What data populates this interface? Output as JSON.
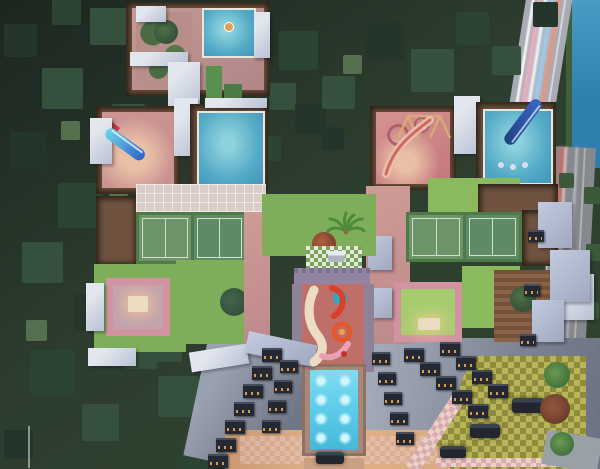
{
  "scene": {
    "type": "3d-aerial-architectural-render",
    "subject": "night-time top-down view of a residential tower complex with rooftop amenity terraces, surrounded by dense trees, a canal and roads with car light trails",
    "features": [
      "rooftop-swimming-pool-left-tower",
      "rooftop-swimming-pool-right-tower",
      "kids-pool-top-terrace",
      "water-slide-blue",
      "pool-slide-navy",
      "tennis-courts-left",
      "tennis-courts-right",
      "seating-courtyard-left",
      "seating-courtyard-right",
      "kids-play-mural",
      "lap-pool-with-underwater-lights",
      "central-lawn-with-palm",
      "checkered-parking-plaza",
      "tower-facade-balconies",
      "forest",
      "canal",
      "road-light-trails",
      "zebra-crossing"
    ]
  },
  "colors": {
    "forest-base-1": "#1c2620",
    "forest-base-2": "#2c3d2e",
    "tree-dark": "#24362b",
    "tree-mid": "#35503c",
    "tree-deep": "#2c4433",
    "tree-edge": "#3c5a3a",
    "tree-light": "#55704f",
    "water-canal": "#2e7fae",
    "water-canal-light": "#4a9cc6",
    "road-top": "#a8abb4",
    "road-side": "#84888f",
    "trail-red": "#ff5a42",
    "trail-orange": "#ff8d6a",
    "trail-white": "#ffffff",
    "trail-blue": "#9fd8ff",
    "trail-pink": "#ffb3c8",
    "slab-white": "#e2e6ee",
    "slab-shade": "#b9c1d3",
    "slab-lavender": "#c3cbdf",
    "deck-brown": "#6f5340",
    "deck-wood": "#8a6348",
    "terrace-pink": "#c6918f",
    "terrace-pink-warm": "#e9bfa6",
    "terrace-red": "#c4777c",
    "pool-water": "#54aac6",
    "pool-water-light": "#8ed2de",
    "lap-pool": "#5cccea",
    "lap-pool-glow": "#d2f6fb",
    "slide-blue-1": "#2f63c8",
    "slide-blue-2": "#6fd2e8",
    "slide-navy": "#20407e",
    "tennis-green-1": "#6c9468",
    "tennis-green-2": "#5e8a66",
    "court-line": "#cfe0cc",
    "lawn-green": "#7fae5a",
    "lawn-bright": "#8ab95e",
    "frame-pink": "#d293a1",
    "seat-cream": "#ecdcc2",
    "paving-light": "#d9cfc8",
    "paving-line": "#efe9e1",
    "mural-base": "#bf6f6a",
    "mural-cream": "#ecdcc6",
    "mural-teal": "#2fa9bf",
    "mural-red": "#d8402a",
    "mural-orange": "#e05a2e",
    "facade-light": "#9aa1b0",
    "facade-dark": "#6f7686",
    "balcony-dark": "#232832",
    "window-amber": "#d89a4e",
    "plaza-warm": "#d8a87c",
    "checker-yellow": "#b8b458",
    "checker-olive": "#8e8c3c",
    "checker-pink": "#d8aab4",
    "checker-cream": "#ecd2c2",
    "car-dark": "#23262e",
    "car-white": "#e9eaee",
    "canopy-check-green": "#79a25c",
    "canopy-check-white": "#e6e8da",
    "wall-purple": "#9385a2"
  }
}
